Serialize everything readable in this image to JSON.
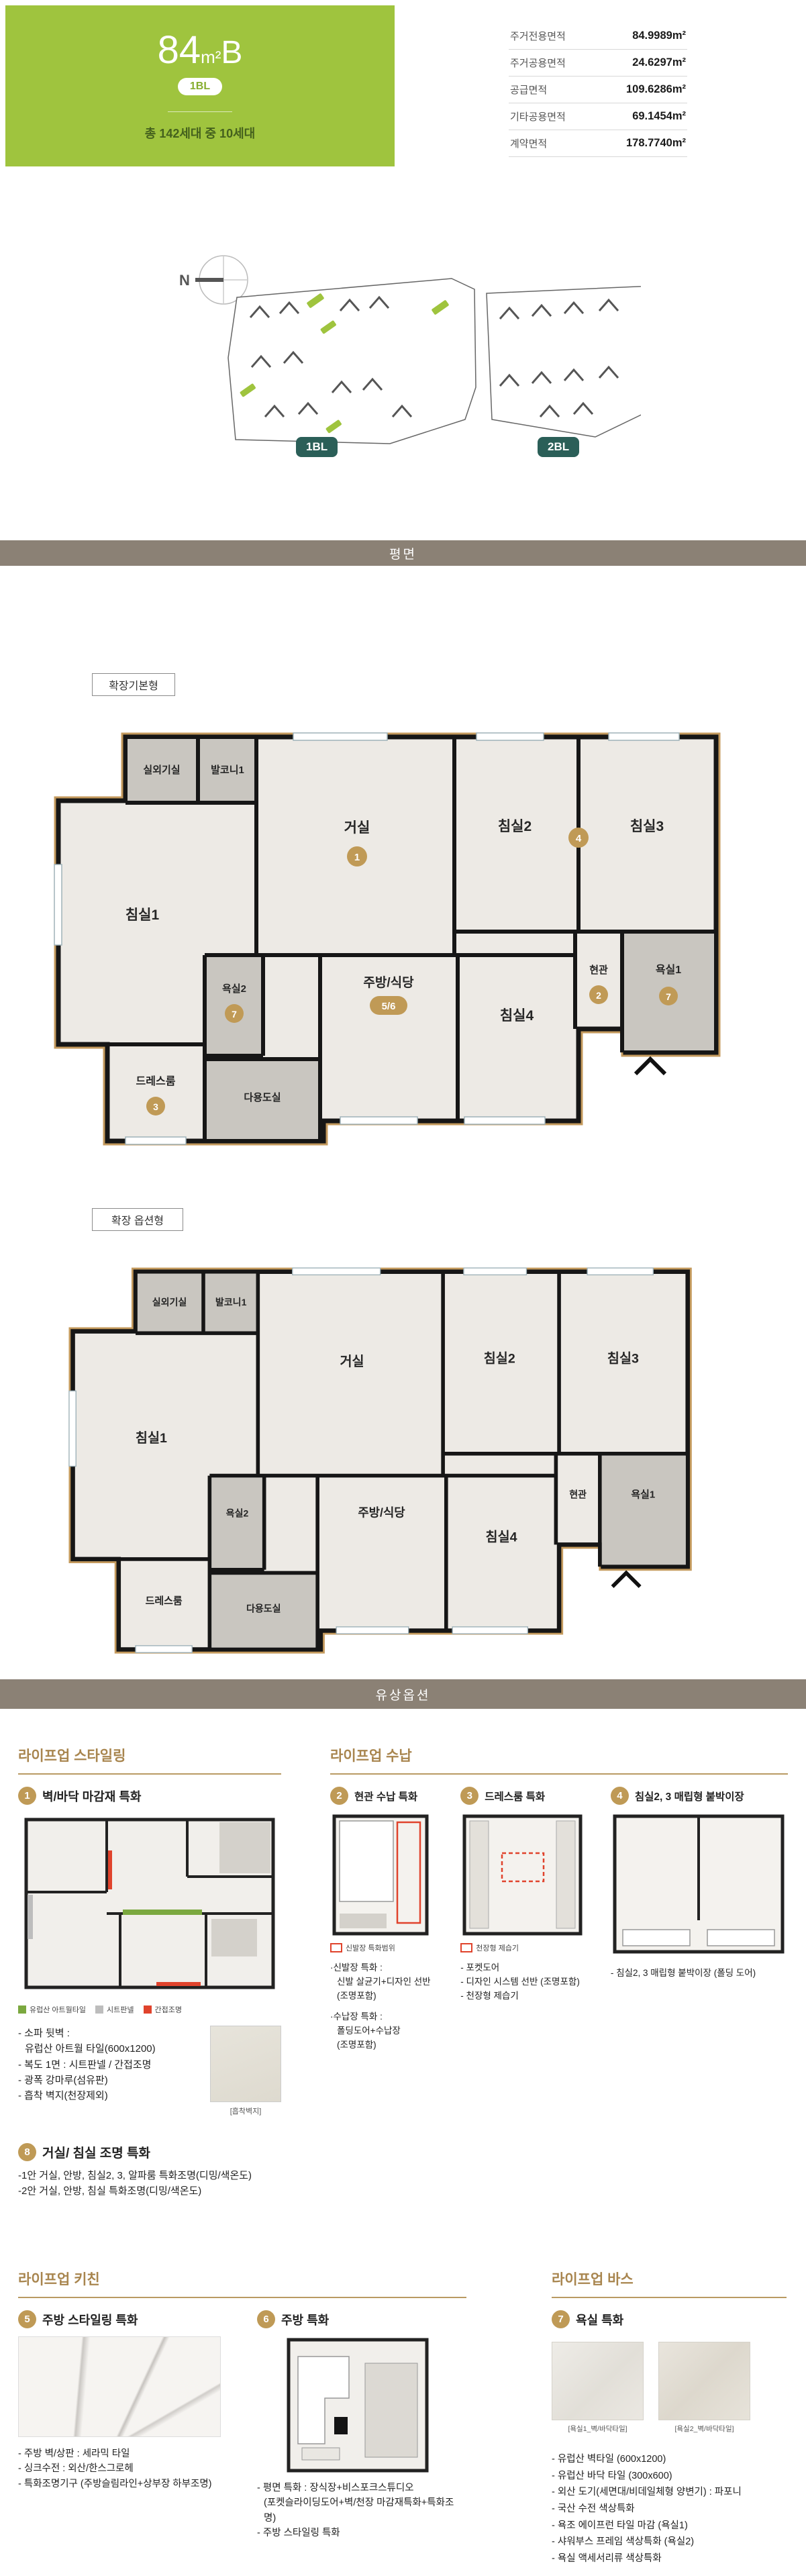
{
  "header": {
    "size_num": "84",
    "size_unit": "m²",
    "size_type": "B",
    "block_badge": "1BL",
    "households": "총 142세대 중 10세대"
  },
  "area_table": {
    "rows": [
      {
        "label": "주거전용면적",
        "value": "84.9989m²"
      },
      {
        "label": "주거공용면적",
        "value": "24.6297m²"
      },
      {
        "label": "공급면적",
        "value": "109.6286m²"
      },
      {
        "label": "기타공용면적",
        "value": "69.1454m²"
      },
      {
        "label": "계약면적",
        "value": "178.7740m²"
      }
    ]
  },
  "site_plan": {
    "north_label": "N",
    "block1_badge": "1BL",
    "block2_badge": "2BL"
  },
  "bars": {
    "plan": "평면",
    "paid_option": "유상옵션"
  },
  "plan_a": {
    "label": "확장기본형",
    "rooms": {
      "outdoor_unit": "실외기실",
      "balcony": "발코니1",
      "bed1": "침실1",
      "living": "거실",
      "bed2": "침실2",
      "bed3": "침실3",
      "bath1": "욕실1",
      "kitchen": "주방/식당",
      "bed4": "침실4",
      "entrance": "현관",
      "bath2": "욕실2",
      "dress": "드레스룸",
      "utility": "다용도실"
    },
    "badges": {
      "living": "1",
      "bed23": "4",
      "bath1": "7",
      "kitchen": "5/6",
      "entrance": "2",
      "bath2": "7",
      "dress": "3"
    }
  },
  "plan_b": {
    "label": "확장 옵션형",
    "rooms": {
      "outdoor_unit": "실외기실",
      "balcony": "발코니1",
      "bed1": "침실1",
      "living": "거실",
      "bed2": "침실2",
      "bed3": "침실3",
      "bath1": "욕실1",
      "kitchen": "주방/식당",
      "bed4": "침실4",
      "entrance": "현관",
      "bath2": "욕실2",
      "dress": "드레스룸",
      "utility": "다용도실"
    }
  },
  "options": {
    "styling": {
      "header": "라이프업 스타일링",
      "item1": {
        "num": "1",
        "title": "벽/바닥 마감재 특화",
        "legend": [
          {
            "label": "유럽산 아트월타일",
            "color": "#7ba83f"
          },
          {
            "label": "시트판넬",
            "color": "#bdbdbd"
          },
          {
            "label": "간접조명",
            "color": "#e0432c"
          }
        ],
        "bullets": [
          "- 소파 뒷벽 :",
          "유럽산 아트월 타일(600x1200)",
          "- 복도 1면 : 시트판넬 / 간접조명",
          "- 광폭 강마루(섬유판)",
          "- 흡착 벽지(천장제외)"
        ],
        "swatch_caption": "[흡착벽지]"
      },
      "item8": {
        "num": "8",
        "title": "거실/ 침실 조명 특화",
        "lines": [
          "-1안 거실, 안방, 침실2, 3, 알파룸 특화조명(디밍/색온도)",
          "-2안 거실, 안방, 침실 특화조명(디밍/색온도)"
        ]
      }
    },
    "storage": {
      "header": "라이프업 수납",
      "item2": {
        "num": "2",
        "title": "현관 수납 특화",
        "legend": "신발장 특화범위",
        "details": [
          "·신발장 특화 :",
          "신발 살균기+디자인 선반",
          "(조명포함)",
          "·수납장 특화 :",
          "폴딩도어+수납장",
          "(조명포함)"
        ]
      },
      "item3": {
        "num": "3",
        "title": "드레스룸 특화",
        "legend": "천장형 제습기",
        "bullets": [
          "- 포켓도어",
          "- 디자인 시스템 선반 (조명포함)",
          "- 천장형 제습기"
        ]
      },
      "item4": {
        "num": "4",
        "title": "침실2, 3 매립형 붙박이장",
        "bullets": [
          "- 침실2, 3 매립형 붙박이장 (폴딩 도어)"
        ]
      }
    },
    "kitchen": {
      "header": "라이프업 키친",
      "item5": {
        "num": "5",
        "title": "주방 스타일링 특화",
        "bullets": [
          "- 주방 벽/상판 : 세라믹 타일",
          "- 싱크수전 : 외산/한스그로헤",
          "- 특화조명기구 (주방슬림라인+상부장 하부조명)"
        ]
      },
      "item6": {
        "num": "6",
        "title": "주방 특화",
        "bullets": [
          "- 평면 특화 : 장식장+비스포크스튜디오",
          "(포켓슬라이딩도어+벽/천장 마감재특화+특화조명)",
          "- 주방 스타일링 특화"
        ]
      }
    },
    "bath": {
      "header": "라이프업 바스",
      "item7": {
        "num": "7",
        "title": "욕실 특화",
        "swatch1_caption": "[욕실1_벽/바닥타일]",
        "swatch2_caption": "[욕실2_벽/바닥타일]",
        "bullets": [
          "- 유럽산 벽타일 (600x1200)",
          "- 유럽산 바닥 타일 (300x600)",
          "- 외산 도기(세면대/비데일체형 양변기) : 파포니",
          "- 국산 수전 색상특화",
          "- 욕조 에이프런 타일 마감 (욕실1)",
          "- 샤워부스 프레임 색상특화 (욕실2)",
          "- 욕실 액세서리류 색상특화"
        ]
      }
    }
  },
  "colors": {
    "brand_green": "#9fc43e",
    "deep_green_text": "#44611d",
    "section_bar": "#8b8175",
    "block_badge": "#2b5f58",
    "gold_accent": "#bf9a56",
    "gold_outline": "#c49a5d",
    "accent_red": "#e0432c"
  }
}
